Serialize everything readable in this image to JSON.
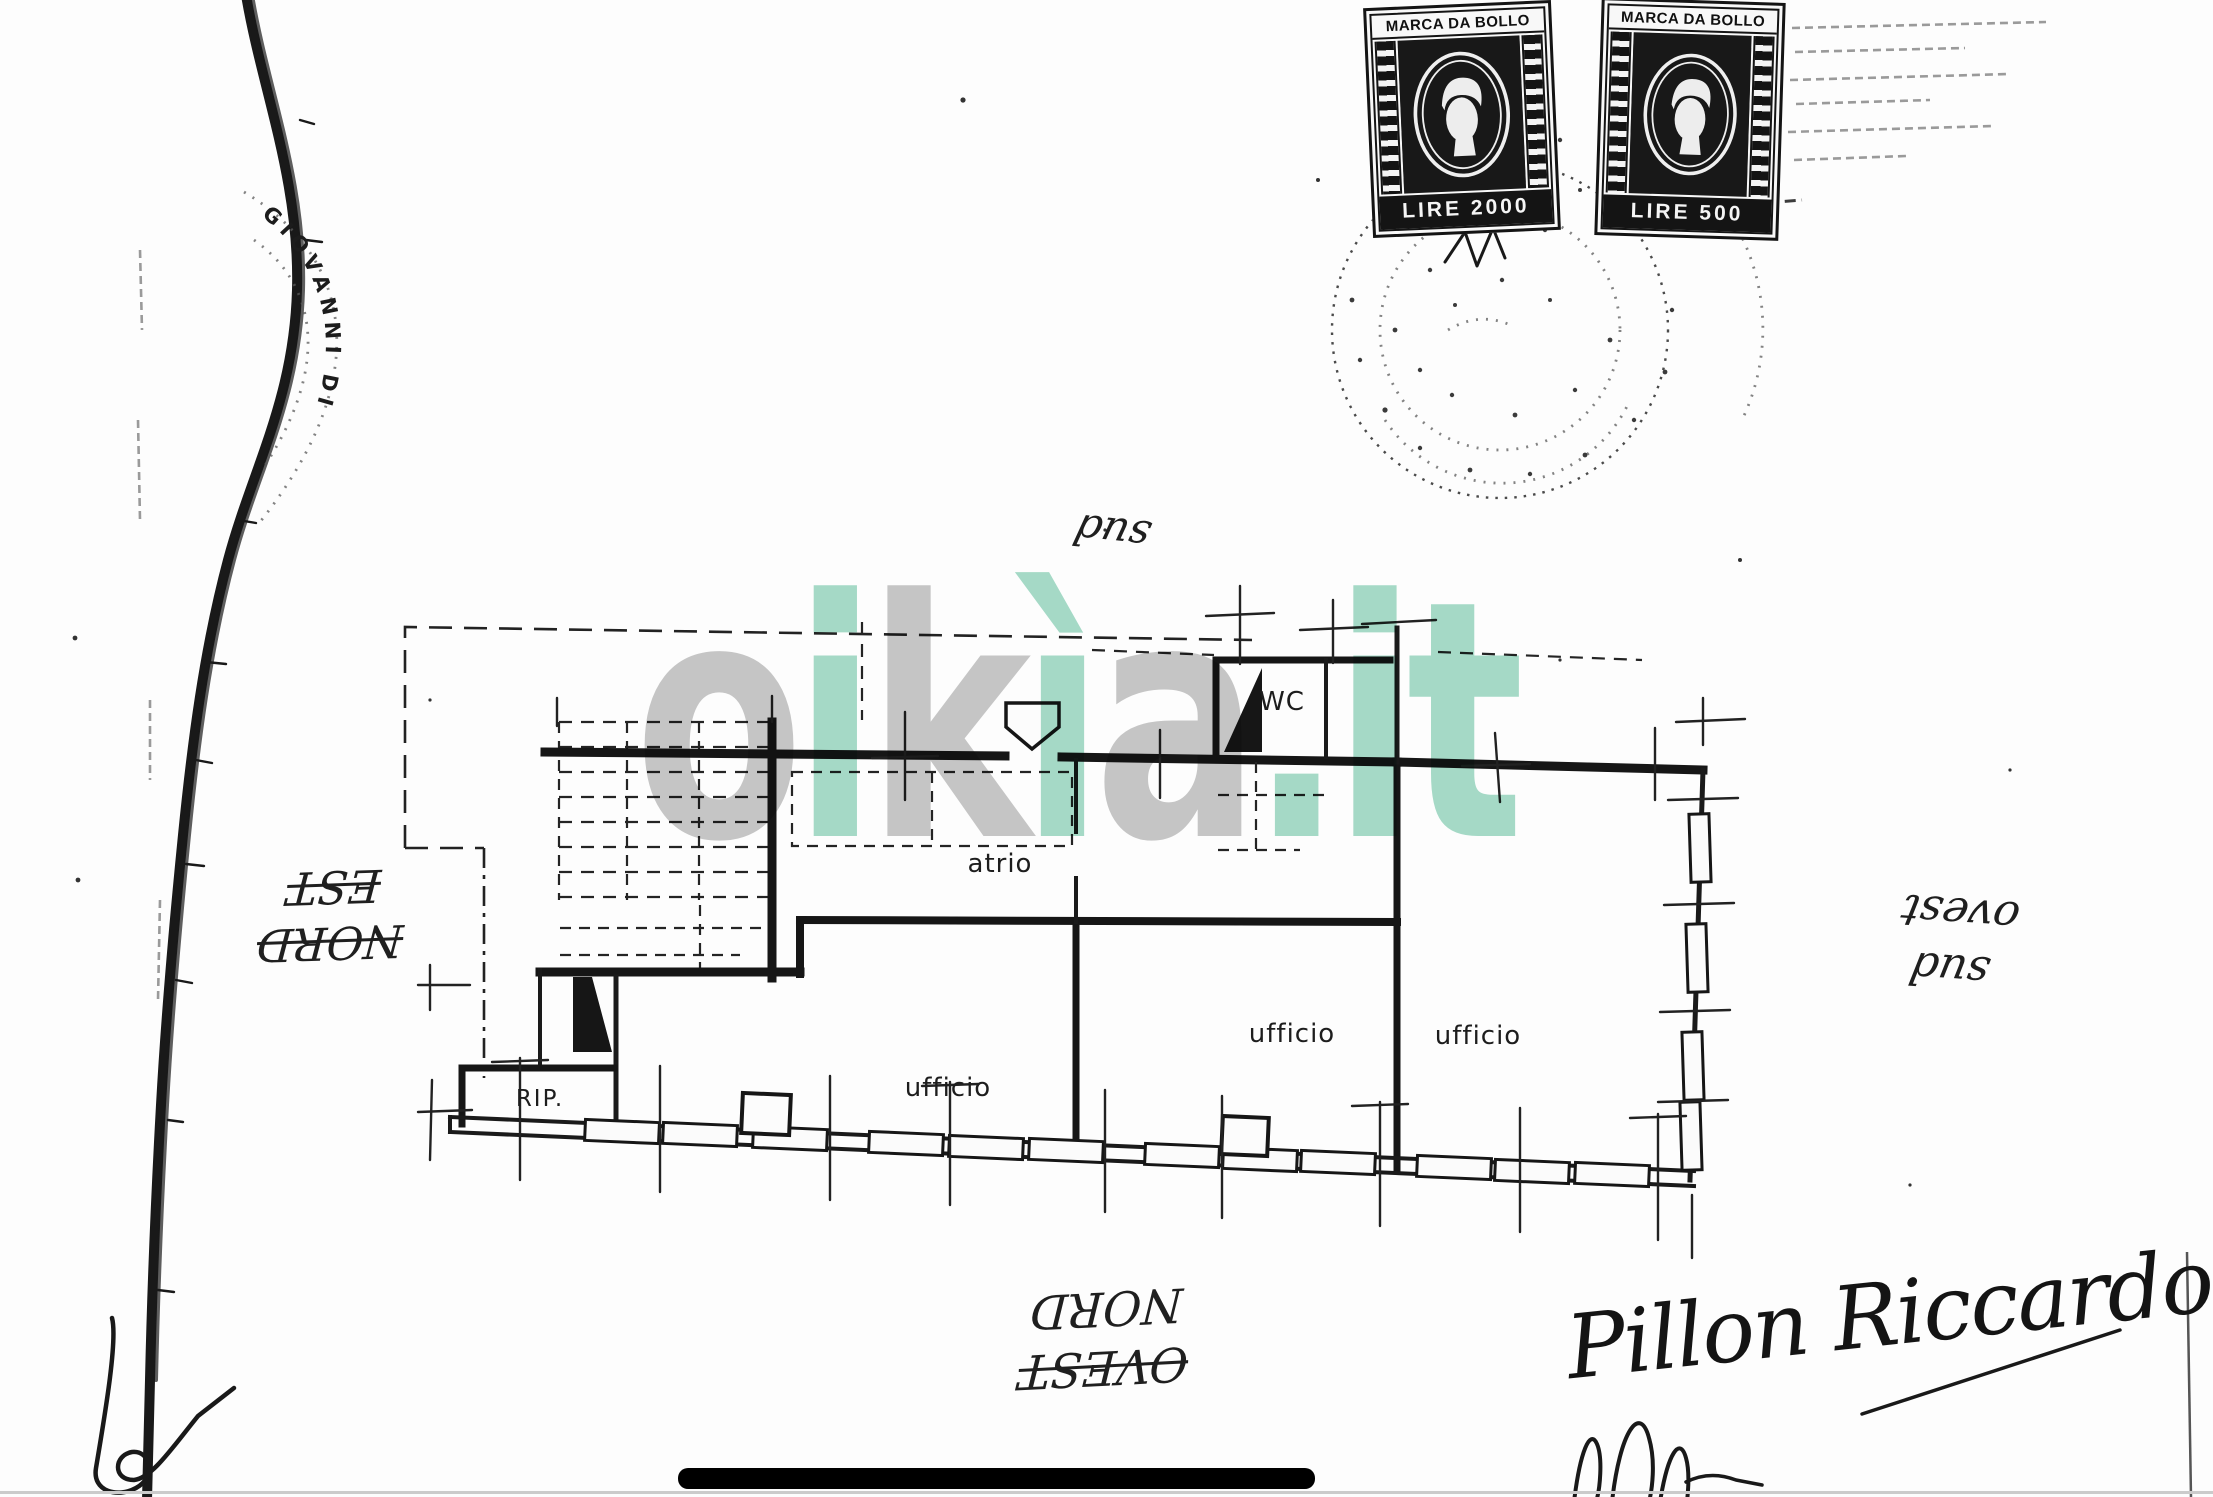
{
  "stamps": {
    "stamp_2000": {
      "header": "MARCA DA BOLLO",
      "value": "LIRE 2000"
    },
    "stamp_500": {
      "header": "MARCA DA BOLLO",
      "value": "LIRE 500"
    }
  },
  "round_stamp": {
    "curved_text": "GIOVANNI DI"
  },
  "floor_plan": {
    "rooms": [
      {
        "label": "WC"
      },
      {
        "label": "atrio"
      },
      {
        "label": "ufficio"
      },
      {
        "label": "ufficio"
      },
      {
        "label": "ufficio"
      },
      {
        "label": "RIP."
      }
    ]
  },
  "orientation_notes": {
    "top": {
      "word": "sud"
    },
    "left": {
      "line1": "EST",
      "line2": "NORD"
    },
    "right": {
      "line1": "ovest",
      "line2": "sud"
    },
    "bottom": {
      "line1": "NORD",
      "line2": "OVEST"
    }
  },
  "signature": {
    "name": "Pillon Riccardo"
  },
  "watermark": {
    "parts": [
      {
        "text": "o",
        "tone": "gray"
      },
      {
        "text": "i",
        "tone": "teal"
      },
      {
        "text": "k",
        "tone": "gray"
      },
      {
        "text": "ì",
        "tone": "teal"
      },
      {
        "text": "a",
        "tone": "gray"
      },
      {
        "text": ".it",
        "tone": "teal"
      }
    ]
  },
  "colors": {
    "watermark_gray": "#c7c7c7",
    "watermark_teal": "#a6dbc8",
    "ink": "#161616",
    "paper": "#fdfdfd"
  }
}
